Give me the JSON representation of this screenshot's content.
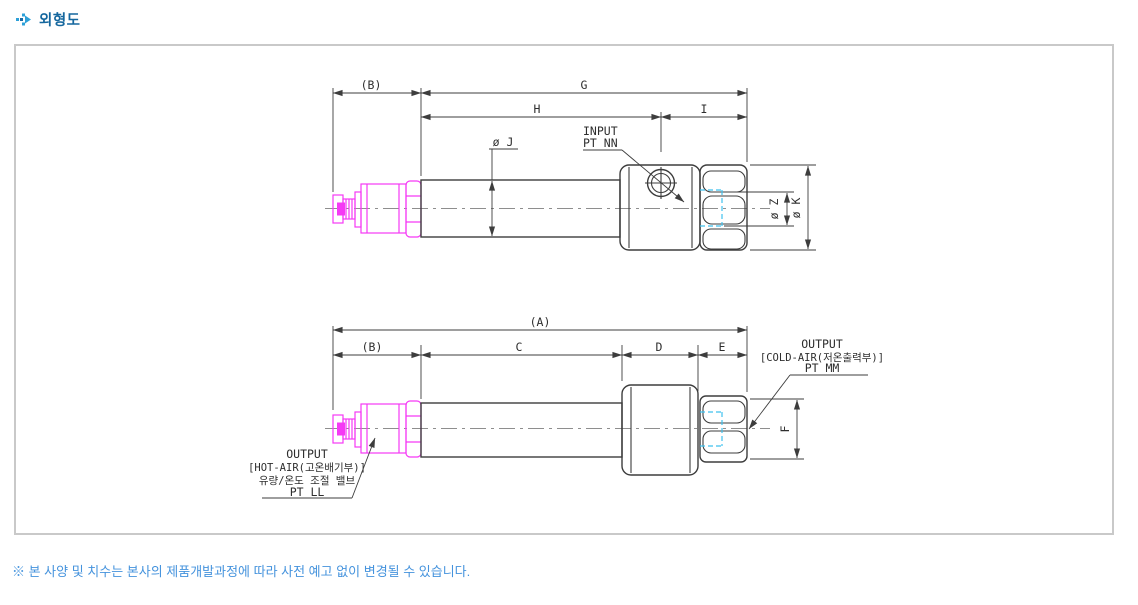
{
  "page": {
    "title": "외형도",
    "note": "※ 본 사양 및 치수는 본사의 제품개발과정에 따라 사전 예고 없이 변경될 수 있습니다."
  },
  "colors": {
    "title_blue": "#15679e",
    "icon_blue": "#2da0d8",
    "note_blue": "#4593dd",
    "drawing_line": "#3d3d3d",
    "fitting_magenta": "#f539f5",
    "hidden_cyan": "#3fc1ee",
    "centerline_gray": "#8e8e8e",
    "frame_border": "#c9c9c9"
  },
  "top": {
    "dims": {
      "b": "(B)",
      "g": "G",
      "h": "H",
      "i": "I",
      "dia_j": "ø J",
      "dia_z": "ø Z",
      "dia_k": "ø K"
    },
    "input": {
      "line1": "INPUT",
      "line2": "PT NN"
    }
  },
  "bottom": {
    "dims": {
      "a": "(A)",
      "b": "(B)",
      "c": "C",
      "d": "D",
      "e": "E",
      "f": "F"
    },
    "cold": {
      "line1": "OUTPUT",
      "line2": "[COLD-AIR(저온출력부)]",
      "line3": "PT MM"
    },
    "hot": {
      "line1": "OUTPUT",
      "line2": "[HOT-AIR(고온배기부)]",
      "line3": "유량/온도 조절 밸브",
      "line4": "PT LL"
    }
  }
}
